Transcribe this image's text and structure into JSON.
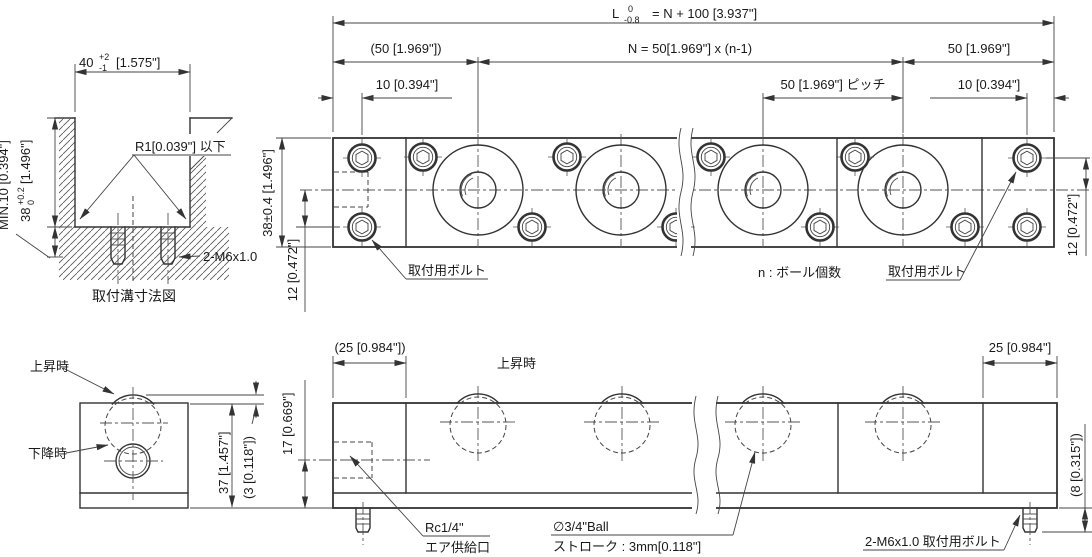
{
  "colors": {
    "line": "#333333",
    "background": "#ffffff"
  },
  "top_dims": {
    "overall_prefix": "L",
    "overall_tol_upper": "0",
    "overall_tol_lower": "-0.8",
    "overall_value": "= N + 100 [3.937\"]",
    "left_end": "(50 [1.969\"])",
    "center": "N = 50[1.969\"] x (n-1)",
    "right_end": "50 [1.969\"]",
    "left_offset": "10 [0.394\"]",
    "pitch": "50 [1.969\"] ピッチ",
    "right_offset": "10 [0.394\"]"
  },
  "top_view": {
    "width_dim": "38±0.4 [1.496\"]",
    "left_bolt_dim": "12 [0.472\"]",
    "right_bolt_dim": "12 [0.472\"]",
    "bolt_label_left": "取付用ボルト",
    "bolt_label_right": "取付用ボルト",
    "ball_count_note": "n : ボール個数"
  },
  "groove_detail": {
    "width_value": "40",
    "width_tol_upper": "+2",
    "width_tol_lower": "-1",
    "width_inch": "[1.575\"]",
    "min_depth": "MIN.10 [0.394\"]",
    "depth_value": "38",
    "depth_tol_upper": "+0.2",
    "depth_tol_lower": "0",
    "depth_inch": "[1.496\"]",
    "radius_note": "R1[0.039\"] 以下",
    "bolt_spec": "2-M6x1.0",
    "caption": "取付溝寸法図"
  },
  "end_view": {
    "raised": "上昇時",
    "lowered": "下降時",
    "height_dim": "37 [1.457\"]",
    "stroke_dim": "(3 [0.118\"])",
    "port_dim": "17 [0.669\"]"
  },
  "side_view": {
    "raised": "上昇時",
    "left_end_dim": "(25 [0.984\"])",
    "right_end_dim": "25 [0.984\"]",
    "protrusion_dim": "(8 [0.315\"])",
    "air_line1": "Rc1/4\"",
    "air_line2": "エア供給口",
    "ball_line1": "∅3/4\"Ball",
    "ball_line2": "ストローク : 3mm[0.118\"]",
    "bolt_note": "2-M6x1.0  取付用ボルト"
  }
}
